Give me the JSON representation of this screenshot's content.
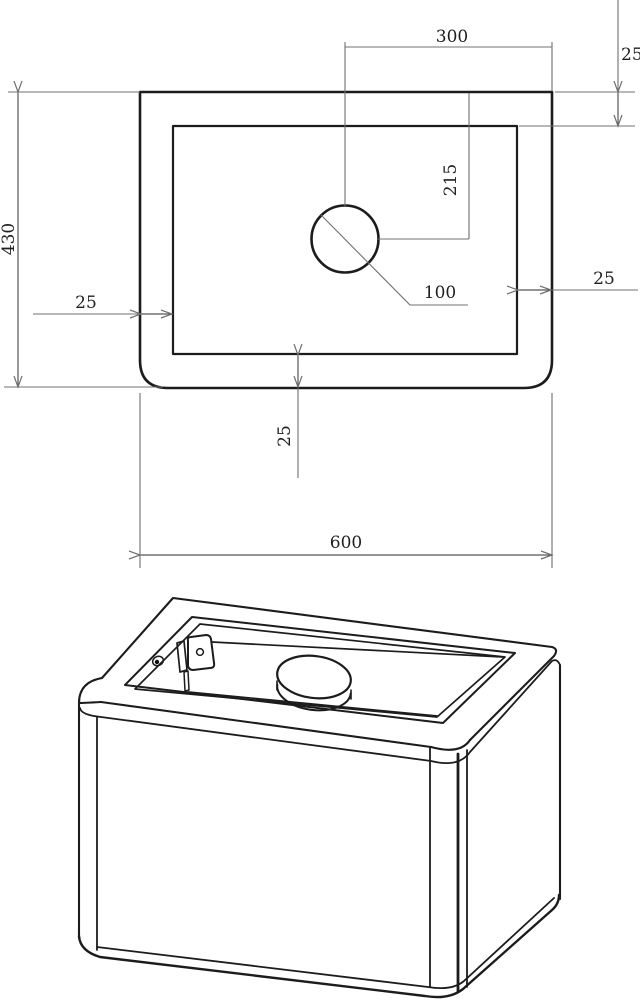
{
  "drawing": {
    "top_view": {
      "dim_hole_center_to_right_edge": "300",
      "dim_top_rim": "25",
      "dim_depth": "430",
      "dim_hole_center_from_top": "215",
      "dim_hole_diameter": "100",
      "dim_left_rim": "25",
      "dim_right_rim": "25",
      "dim_bottom_rim": "25",
      "dim_width": "600"
    },
    "colors": {
      "object_line": "#1c1c1c",
      "dimension_line": "#707070",
      "text": "#1f1f1f",
      "background": "#ffffff"
    }
  }
}
